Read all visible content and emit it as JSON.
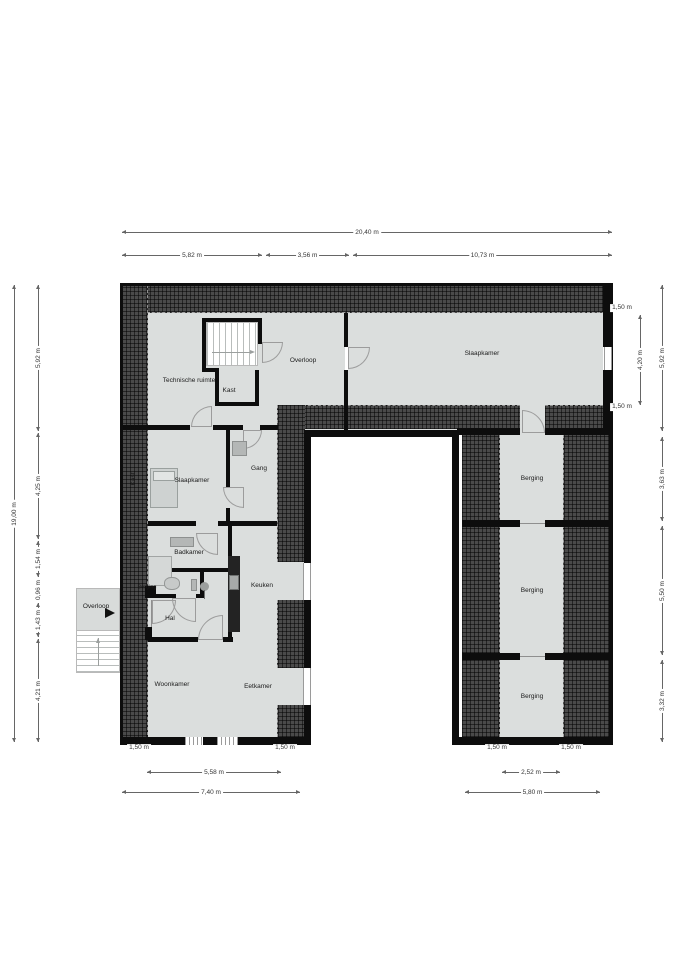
{
  "title": "Floor plan",
  "colors": {
    "floor": "#dbdedd",
    "wall": "#0d0d0d",
    "hatch": "#4a4a4a",
    "door": "#9c9c9c",
    "dim": "#666666",
    "text": "#1b1b1b"
  },
  "canvas": {
    "w": 679,
    "h": 960
  },
  "plan": {
    "floors": [
      {
        "x": 148,
        "y": 313,
        "w": 197,
        "h": 117
      },
      {
        "x": 348,
        "y": 313,
        "w": 255,
        "h": 122
      },
      {
        "x": 148,
        "y": 430,
        "w": 157,
        "h": 310
      },
      {
        "x": 462,
        "y": 435,
        "w": 148,
        "h": 305
      }
    ],
    "hatches": [
      {
        "x": 122,
        "y": 285,
        "w": 488,
        "h": 28,
        "edge": "bottom"
      },
      {
        "x": 122,
        "y": 285,
        "w": 26,
        "h": 455,
        "edge": "right"
      },
      {
        "x": 278,
        "y": 405,
        "w": 242,
        "h": 24,
        "edge": "top"
      },
      {
        "x": 545,
        "y": 405,
        "w": 58,
        "h": 24,
        "edge": "top"
      },
      {
        "x": 277,
        "y": 405,
        "w": 28,
        "h": 157,
        "edge": "left"
      },
      {
        "x": 277,
        "y": 600,
        "w": 28,
        "h": 68,
        "edge": "left"
      },
      {
        "x": 277,
        "y": 705,
        "w": 28,
        "h": 32,
        "edge": "left"
      },
      {
        "x": 462,
        "y": 435,
        "w": 38,
        "h": 302,
        "edge": "right"
      },
      {
        "x": 563,
        "y": 435,
        "w": 47,
        "h": 302,
        "edge": "left"
      }
    ],
    "walls": [
      {
        "x": 120,
        "y": 283,
        "w": 492,
        "h": 3
      },
      {
        "x": 120,
        "y": 283,
        "w": 3,
        "h": 462
      },
      {
        "x": 609,
        "y": 283,
        "w": 4,
        "h": 462
      },
      {
        "x": 120,
        "y": 737,
        "w": 186,
        "h": 8
      },
      {
        "x": 455,
        "y": 737,
        "w": 157,
        "h": 8
      },
      {
        "x": 304,
        "y": 430,
        "w": 7,
        "h": 133
      },
      {
        "x": 304,
        "y": 600,
        "w": 7,
        "h": 68
      },
      {
        "x": 304,
        "y": 705,
        "w": 7,
        "h": 40
      },
      {
        "x": 452,
        "y": 430,
        "w": 7,
        "h": 315
      },
      {
        "x": 305,
        "y": 430,
        "w": 150,
        "h": 7
      },
      {
        "x": 344,
        "y": 313,
        "w": 4,
        "h": 34
      },
      {
        "x": 344,
        "y": 370,
        "w": 4,
        "h": 60
      },
      {
        "x": 202,
        "y": 318,
        "w": 60,
        "h": 4
      },
      {
        "x": 202,
        "y": 318,
        "w": 4,
        "h": 54
      },
      {
        "x": 202,
        "y": 368,
        "w": 17,
        "h": 4
      },
      {
        "x": 258,
        "y": 318,
        "w": 4,
        "h": 26
      },
      {
        "x": 215,
        "y": 370,
        "w": 4,
        "h": 36
      },
      {
        "x": 255,
        "y": 370,
        "w": 4,
        "h": 36
      },
      {
        "x": 215,
        "y": 402,
        "w": 44,
        "h": 4
      },
      {
        "x": 122,
        "y": 425,
        "w": 68,
        "h": 5
      },
      {
        "x": 213,
        "y": 425,
        "w": 30,
        "h": 5
      },
      {
        "x": 260,
        "y": 425,
        "w": 18,
        "h": 5
      },
      {
        "x": 457,
        "y": 428,
        "w": 63,
        "h": 7
      },
      {
        "x": 545,
        "y": 428,
        "w": 65,
        "h": 7
      },
      {
        "x": 603,
        "y": 285,
        "w": 9,
        "h": 62
      },
      {
        "x": 603,
        "y": 370,
        "w": 9,
        "h": 60
      },
      {
        "x": 226,
        "y": 430,
        "w": 4,
        "h": 57
      },
      {
        "x": 226,
        "y": 508,
        "w": 4,
        "h": 14
      },
      {
        "x": 148,
        "y": 521,
        "w": 48,
        "h": 5
      },
      {
        "x": 218,
        "y": 521,
        "w": 59,
        "h": 5
      },
      {
        "x": 228,
        "y": 526,
        "w": 4,
        "h": 112
      },
      {
        "x": 152,
        "y": 568,
        "w": 80,
        "h": 4
      },
      {
        "x": 152,
        "y": 594,
        "w": 24,
        "h": 4
      },
      {
        "x": 196,
        "y": 594,
        "w": 8,
        "h": 4
      },
      {
        "x": 152,
        "y": 568,
        "w": 4,
        "h": 30
      },
      {
        "x": 200,
        "y": 568,
        "w": 4,
        "h": 30
      },
      {
        "x": 148,
        "y": 637,
        "w": 50,
        "h": 5
      },
      {
        "x": 223,
        "y": 637,
        "w": 10,
        "h": 5
      },
      {
        "x": 145,
        "y": 586,
        "w": 7,
        "h": 12
      },
      {
        "x": 145,
        "y": 627,
        "w": 7,
        "h": 13
      },
      {
        "x": 462,
        "y": 520,
        "w": 58,
        "h": 7
      },
      {
        "x": 545,
        "y": 520,
        "w": 65,
        "h": 7
      },
      {
        "x": 462,
        "y": 653,
        "w": 58,
        "h": 7
      },
      {
        "x": 545,
        "y": 653,
        "w": 65,
        "h": 7
      }
    ],
    "windows": [
      {
        "x": 604,
        "y": 347,
        "w": 8,
        "h": 23,
        "dir": "v"
      },
      {
        "x": 303,
        "y": 563,
        "w": 8,
        "h": 37,
        "dir": "v"
      },
      {
        "x": 303,
        "y": 668,
        "w": 8,
        "h": 37,
        "dir": "v"
      },
      {
        "x": 185,
        "y": 737,
        "w": 18,
        "h": 8,
        "dir": "s"
      },
      {
        "x": 217,
        "y": 737,
        "w": 21,
        "h": 8,
        "dir": "s"
      }
    ],
    "lines": [
      {
        "x": 520,
        "y": 523,
        "w": 25,
        "h": 1
      },
      {
        "x": 520,
        "y": 656,
        "w": 25,
        "h": 1
      },
      {
        "x": 151,
        "y": 600,
        "w": 1,
        "h": 27
      }
    ],
    "doors": [
      {
        "x": 262,
        "y": 342,
        "s": 21,
        "hinge": "tl"
      },
      {
        "x": 191,
        "y": 406,
        "s": 21,
        "hinge": "br"
      },
      {
        "x": 348,
        "y": 347,
        "s": 22,
        "hinge": "tl"
      },
      {
        "x": 522,
        "y": 410,
        "s": 23,
        "hinge": "bl"
      },
      {
        "x": 243,
        "y": 430,
        "s": 19,
        "hinge": "tl"
      },
      {
        "x": 223,
        "y": 487,
        "s": 21,
        "hinge": "tr"
      },
      {
        "x": 196,
        "y": 533,
        "s": 22,
        "hinge": "tr"
      },
      {
        "x": 152,
        "y": 600,
        "s": 24,
        "hinge": "tl"
      },
      {
        "x": 172,
        "y": 598,
        "s": 24,
        "hinge": "tr"
      },
      {
        "x": 198,
        "y": 615,
        "s": 25,
        "hinge": "br"
      }
    ],
    "furniture": [
      {
        "kind": "bed",
        "x": 150,
        "y": 468,
        "w": 28,
        "h": 40,
        "fill": "#ced2d1",
        "border": "#9aa09e"
      },
      {
        "kind": "pillow",
        "x": 153,
        "y": 471,
        "w": 22,
        "h": 10,
        "fill": "#e2e5e4",
        "border": "#9aa09e"
      },
      {
        "kind": "cabinet",
        "x": 232,
        "y": 441,
        "w": 15,
        "h": 15,
        "fill": "#b4b7b6",
        "border": "#8d908f"
      },
      {
        "kind": "sink",
        "x": 170,
        "y": 537,
        "w": 24,
        "h": 10,
        "fill": "#b4b7b6",
        "border": "#8d908f"
      },
      {
        "kind": "shower",
        "x": 148,
        "y": 556,
        "w": 24,
        "h": 30,
        "fill": "#d5d8d7",
        "border": "#a2a5a4"
      },
      {
        "kind": "toilet",
        "x": 164,
        "y": 577,
        "w": 16,
        "h": 13,
        "fill": "#c7cac9",
        "border": "#949796",
        "radius": "45%"
      },
      {
        "kind": "toilet-sink",
        "x": 191,
        "y": 579,
        "w": 6,
        "h": 12,
        "fill": "#b4b7b6",
        "border": "#8d908f"
      },
      {
        "kind": "pedestal",
        "x": 200,
        "y": 582,
        "w": 9,
        "h": 9,
        "fill": "#9c9f9e",
        "radius": "50%"
      },
      {
        "kind": "pedestal-stem",
        "x": 204,
        "y": 590,
        "w": 1,
        "h": 9,
        "fill": "#6f7271"
      },
      {
        "kind": "kitchen-counter",
        "x": 228,
        "y": 556,
        "w": 12,
        "h": 76,
        "fill": "#232323"
      },
      {
        "kind": "stove",
        "x": 229,
        "y": 575,
        "w": 10,
        "h": 15,
        "fill": "#a7aaa9",
        "border": "#6f7271"
      },
      {
        "kind": "entry-landing",
        "x": 76,
        "y": 588,
        "w": 44,
        "h": 43,
        "fill": "#d8dbda",
        "border": "#b9b9b9"
      }
    ],
    "stairs": [
      {
        "x": 206,
        "y": 322,
        "w": 52,
        "h": 44,
        "dir": "v"
      },
      {
        "x": 76,
        "y": 630,
        "w": 44,
        "h": 43,
        "dir": "h"
      }
    ],
    "arrows": [
      {
        "x1": 212,
        "y1": 352,
        "x2": 250,
        "y2": 352,
        "head": "right"
      },
      {
        "x1": 98,
        "y1": 666,
        "x2": 98,
        "y2": 638,
        "head": "up"
      },
      {
        "x": 105,
        "y": 608,
        "solid": true
      }
    ],
    "labels": [
      {
        "x": 189,
        "y": 381,
        "t": "Technische ruimte"
      },
      {
        "x": 229,
        "y": 391,
        "t": "Kast"
      },
      {
        "x": 303,
        "y": 361,
        "t": "Overloop"
      },
      {
        "x": 482,
        "y": 354,
        "t": "Slaapkamer"
      },
      {
        "x": 134,
        "y": 479,
        "t": "Kast",
        "rot": true
      },
      {
        "x": 192,
        "y": 481,
        "t": "Slaapkamer"
      },
      {
        "x": 259,
        "y": 469,
        "t": "Gang"
      },
      {
        "x": 189,
        "y": 553,
        "t": "Badkamer"
      },
      {
        "x": 147,
        "y": 588,
        "t": "Berging",
        "size": 5.5
      },
      {
        "x": 170,
        "y": 619,
        "t": "Hal"
      },
      {
        "x": 262,
        "y": 586,
        "t": "Keuken"
      },
      {
        "x": 96,
        "y": 607,
        "t": "Overloop"
      },
      {
        "x": 172,
        "y": 685,
        "t": "Woonkamer"
      },
      {
        "x": 258,
        "y": 687,
        "t": "Eetkamer"
      },
      {
        "x": 532,
        "y": 479,
        "t": "Berging"
      },
      {
        "x": 532,
        "y": 591,
        "t": "Berging"
      },
      {
        "x": 532,
        "y": 697,
        "t": "Berging"
      }
    ]
  },
  "dimensions": {
    "horizontal": [
      {
        "x1": 122,
        "x2": 612,
        "y": 232,
        "label": "20,40 m"
      },
      {
        "x1": 122,
        "x2": 262,
        "y": 255,
        "label": "5,82 m"
      },
      {
        "x1": 266,
        "x2": 349,
        "y": 255,
        "label": "3,56 m"
      },
      {
        "x1": 353,
        "x2": 612,
        "y": 255,
        "label": "10,73 m"
      },
      {
        "x1": 147,
        "x2": 281,
        "y": 772,
        "label": "5,58 m"
      },
      {
        "x1": 122,
        "x2": 300,
        "y": 792,
        "label": "7,40 m"
      },
      {
        "x1": 502,
        "x2": 560,
        "y": 772,
        "label": "2,52 m"
      },
      {
        "x1": 465,
        "x2": 600,
        "y": 792,
        "label": "5,80 m"
      }
    ],
    "vertical": [
      {
        "x": 14,
        "y1": 285,
        "y2": 742,
        "label": "19,00 m"
      },
      {
        "x": 38,
        "y1": 285,
        "y2": 431,
        "label": "5,92 m"
      },
      {
        "x": 38,
        "y1": 433,
        "y2": 539,
        "label": "4,25 m"
      },
      {
        "x": 38,
        "y1": 541,
        "y2": 577,
        "label": "1,54 m"
      },
      {
        "x": 38,
        "y1": 579,
        "y2": 601,
        "label": "0,96 m"
      },
      {
        "x": 38,
        "y1": 603,
        "y2": 637,
        "label": "1,43 m"
      },
      {
        "x": 38,
        "y1": 639,
        "y2": 742,
        "label": "4,21 m"
      },
      {
        "x": 640,
        "y1": 315,
        "y2": 405,
        "label": "4,20 m"
      },
      {
        "x": 662,
        "y1": 285,
        "y2": 431,
        "label": "5,92 m"
      },
      {
        "x": 662,
        "y1": 437,
        "y2": 521,
        "label": "3,63 m"
      },
      {
        "x": 662,
        "y1": 526,
        "y2": 655,
        "label": "5,50 m"
      },
      {
        "x": 662,
        "y1": 660,
        "y2": 742,
        "label": "3,32 m"
      }
    ],
    "texts": [
      {
        "x": 622,
        "y": 308,
        "label": "1,50 m"
      },
      {
        "x": 622,
        "y": 407,
        "label": "1,50 m"
      },
      {
        "x": 139,
        "y": 748,
        "label": "1,50 m"
      },
      {
        "x": 285,
        "y": 748,
        "label": "1,50 m"
      },
      {
        "x": 497,
        "y": 748,
        "label": "1,50 m"
      },
      {
        "x": 571,
        "y": 748,
        "label": "1,50 m"
      }
    ]
  }
}
